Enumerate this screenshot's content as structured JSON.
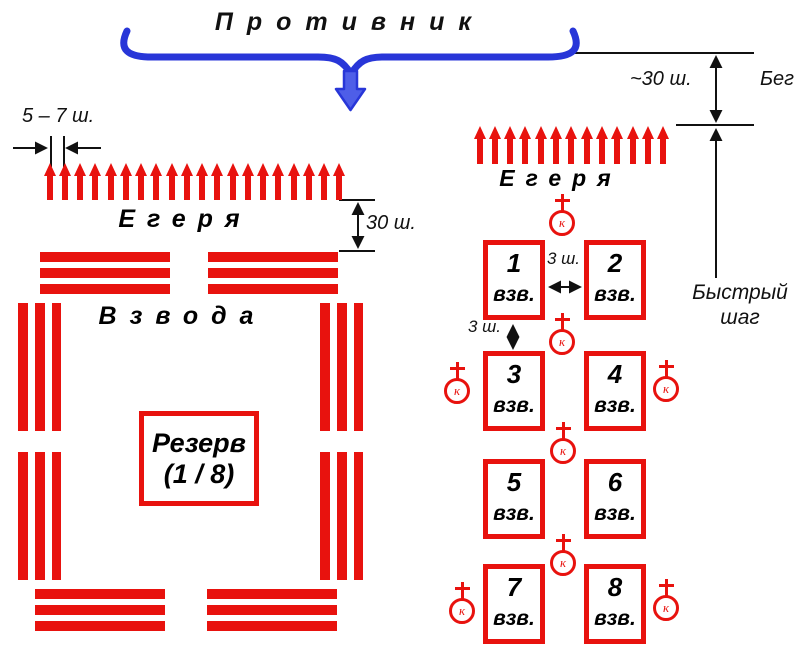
{
  "colors": {
    "red": "#e8120e",
    "blue": "#2836d8",
    "blue_arrow_fill": "#4e5ee8",
    "ink": "#111111",
    "title": "#111111"
  },
  "top": {
    "enemy_label": "Противник"
  },
  "dimensions": {
    "approach_distance": "~30 ш.",
    "run_label": "Бег",
    "fast_step_line1": "Быстрый",
    "fast_step_line2": "шаг",
    "skirmisher_spacing": "5 – 7 ш.",
    "left_depth": "30 ш.",
    "gap_horizontal": "3 ш.",
    "gap_vertical": "3 ш."
  },
  "left_formation": {
    "jaeger_label": "Егеря",
    "platoons_label": "Взвода",
    "reserve_line1": "Резерв",
    "reserve_line2": "(1 / 8)",
    "skirmisher_count": 20
  },
  "right_formation": {
    "jaeger_label": "Егеря",
    "commander_letter": "к",
    "skirmisher_count": 13,
    "platoons": [
      {
        "num": "1",
        "label": "взв."
      },
      {
        "num": "2",
        "label": "взв."
      },
      {
        "num": "3",
        "label": "взв."
      },
      {
        "num": "4",
        "label": "взв."
      },
      {
        "num": "5",
        "label": "взв."
      },
      {
        "num": "6",
        "label": "взв."
      },
      {
        "num": "7",
        "label": "взв."
      },
      {
        "num": "8",
        "label": "взв."
      }
    ]
  }
}
